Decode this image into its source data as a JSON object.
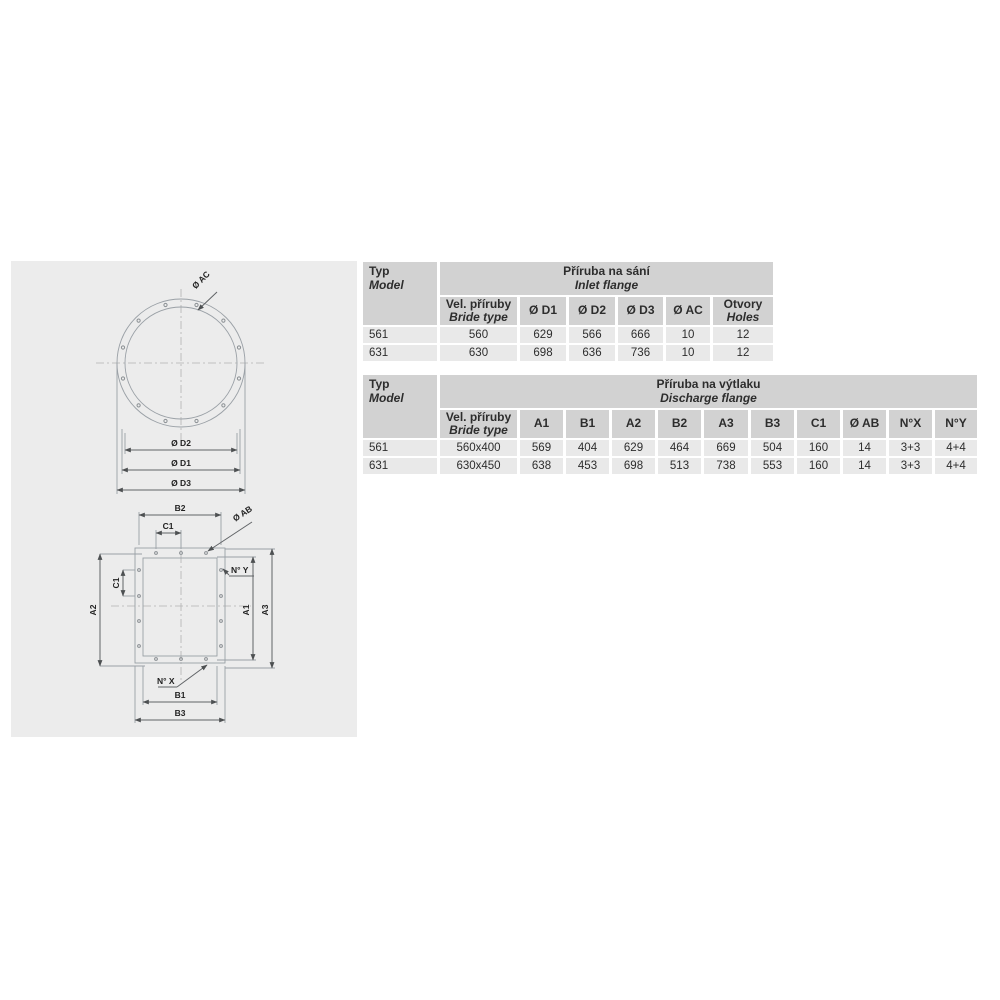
{
  "colors": {
    "page_bg": "#ffffff",
    "panel_bg": "#ececec",
    "table_header_bg": "#d2d2d2",
    "table_row_bg": "#e9e9e9",
    "text": "#2d2d2d",
    "drawing_line": "#9aa0a6",
    "dimension_line": "#606366"
  },
  "drawing": {
    "circle_labels": {
      "ac": "Ø AC",
      "d2": "Ø D2",
      "d1": "Ø D1",
      "d3": "Ø D3"
    },
    "rect_labels": {
      "b2": "B2",
      "c1_top": "C1",
      "ab": "Ø AB",
      "ny": "N° Y",
      "a2": "A2",
      "c1_left": "C1",
      "a1": "A1",
      "a3": "A3",
      "nx": "N° X",
      "b1": "B1",
      "b3": "B3"
    }
  },
  "tables": {
    "inlet": {
      "model_header": {
        "line1": "Typ",
        "line2": "Model"
      },
      "title": {
        "line1": "Příruba na sání",
        "line2": "Inlet flange"
      },
      "columns": [
        {
          "line1": "Vel. příruby",
          "line2": "Bride type"
        },
        {
          "label": "Ø D1"
        },
        {
          "label": "Ø D2"
        },
        {
          "label": "Ø D3"
        },
        {
          "label": "Ø AC"
        },
        {
          "line1": "Otvory",
          "line2": "Holes"
        }
      ],
      "rows": [
        [
          "561",
          "560",
          "629",
          "566",
          "666",
          "10",
          "12"
        ],
        [
          "631",
          "630",
          "698",
          "636",
          "736",
          "10",
          "12"
        ]
      ]
    },
    "discharge": {
      "model_header": {
        "line1": "Typ",
        "line2": "Model"
      },
      "title": {
        "line1": "Příruba na výtlaku",
        "line2": "Discharge flange"
      },
      "columns": [
        {
          "line1": "Vel. příruby",
          "line2": "Bride type"
        },
        {
          "label": "A1"
        },
        {
          "label": "B1"
        },
        {
          "label": "A2"
        },
        {
          "label": "B2"
        },
        {
          "label": "A3"
        },
        {
          "label": "B3"
        },
        {
          "label": "C1"
        },
        {
          "label": "Ø AB"
        },
        {
          "label": "N°X"
        },
        {
          "label": "N°Y"
        }
      ],
      "rows": [
        [
          "561",
          "560x400",
          "569",
          "404",
          "629",
          "464",
          "669",
          "504",
          "160",
          "14",
          "3+3",
          "4+4"
        ],
        [
          "631",
          "630x450",
          "638",
          "453",
          "698",
          "513",
          "738",
          "553",
          "160",
          "14",
          "3+3",
          "4+4"
        ]
      ]
    }
  }
}
